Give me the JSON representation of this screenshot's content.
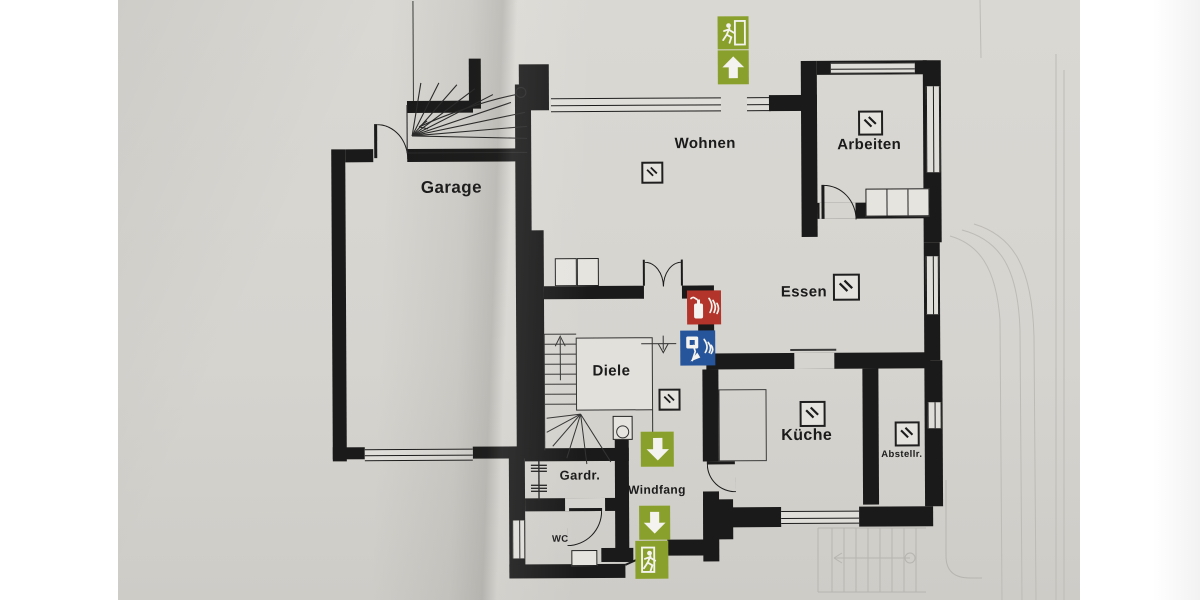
{
  "photo": {
    "paper_color": "#d6d4cf",
    "background_color": "#ffffff"
  },
  "colors": {
    "wall_black": "#1a1a1a",
    "exit_green": "#8aa02c",
    "fire_red": "#b2342a",
    "alarm_blue": "#27559c"
  },
  "rooms": [
    {
      "id": "garage",
      "label": "Garage"
    },
    {
      "id": "wohnen",
      "label": "Wohnen"
    },
    {
      "id": "arbeiten",
      "label": "Arbeiten"
    },
    {
      "id": "essen",
      "label": "Essen"
    },
    {
      "id": "kueche",
      "label": "Küche"
    },
    {
      "id": "abstellraum",
      "label": "Abstellr."
    },
    {
      "id": "diele",
      "label": "Diele"
    },
    {
      "id": "garderobe",
      "label": "Gardr."
    },
    {
      "id": "windfang",
      "label": "Windfang"
    },
    {
      "id": "wc",
      "label": "WC"
    }
  ],
  "safety_signs": [
    {
      "id": "exit-route-up",
      "icons": [
        "running-man-icon",
        "arrow-up-icon"
      ],
      "color": "#8aa02c"
    },
    {
      "id": "fire-extinguisher",
      "icons": [
        "fire-extinguisher-icon",
        "flames-icon"
      ],
      "color": "#b2342a"
    },
    {
      "id": "manual-call-point",
      "icons": [
        "alarm-button-hand-icon",
        "flames-icon"
      ],
      "color": "#27559c"
    },
    {
      "id": "exit-route-down",
      "icons": [
        "arrow-down-icon"
      ],
      "color": "#8aa02c"
    },
    {
      "id": "final-exit-down",
      "icons": [
        "arrow-down-icon",
        "running-man-icon"
      ],
      "color": "#8aa02c"
    }
  ],
  "detector_symbol": {
    "name": "diagonal-slash-square-icon",
    "count": 6
  }
}
